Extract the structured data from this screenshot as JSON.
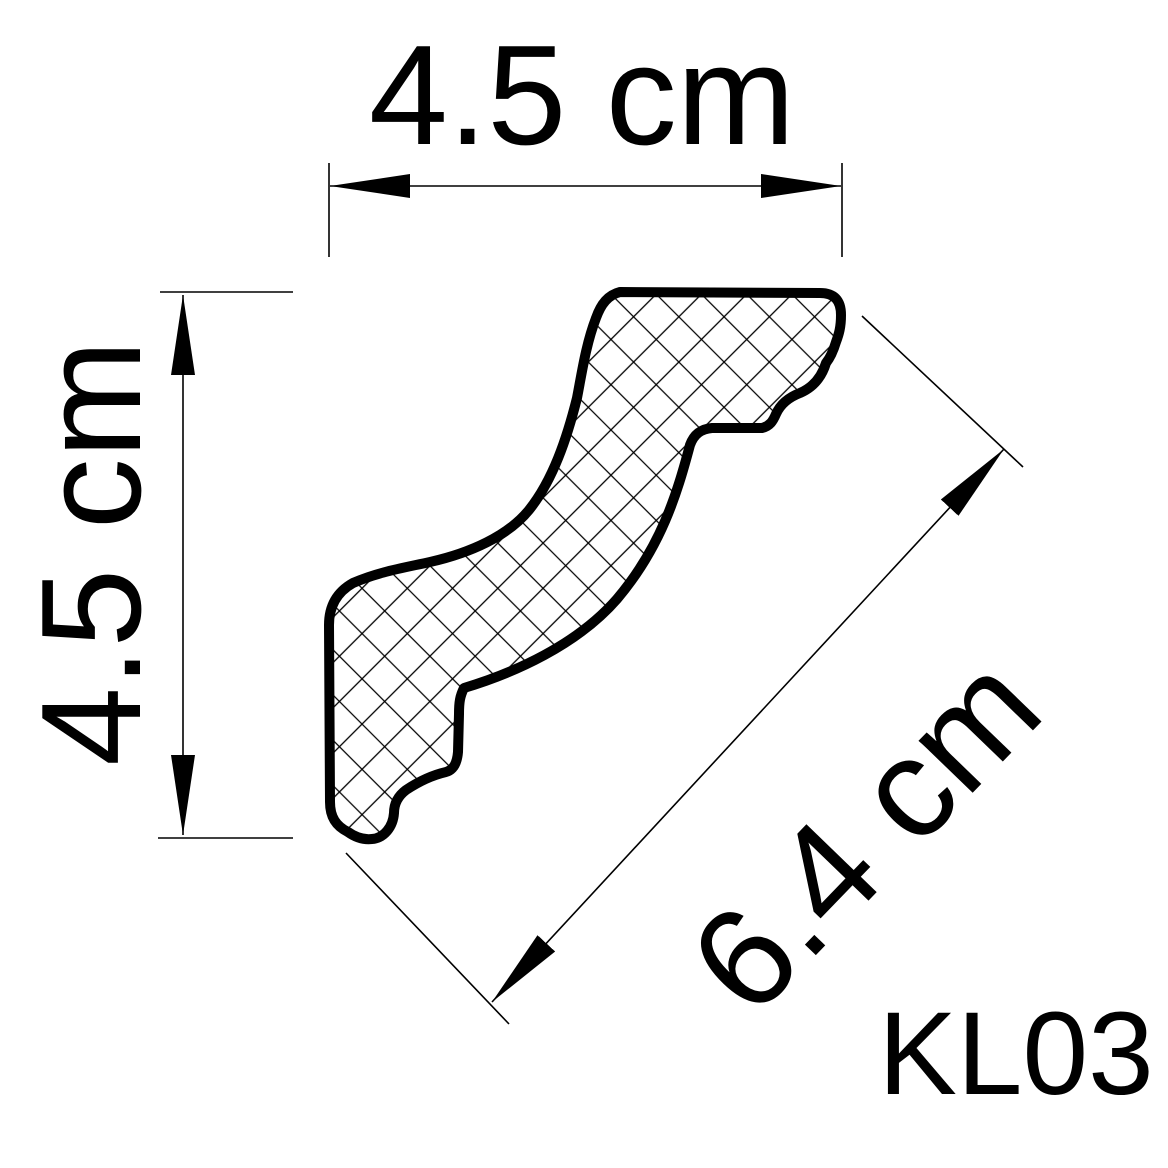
{
  "product": {
    "code": "KL03"
  },
  "dimensions": {
    "width_top": {
      "label": "4.5 cm",
      "value": 4.5,
      "unit": "cm",
      "orientation": "horizontal"
    },
    "height_left": {
      "label": "4.5 cm",
      "value": 4.5,
      "unit": "cm",
      "orientation": "vertical"
    },
    "face_diagonal": {
      "label": "6.4 cm",
      "value": 6.4,
      "unit": "cm",
      "orientation": "diagonal"
    }
  },
  "drawing": {
    "subject": "crown-molding-cross-section-profile",
    "fill_pattern": "crosshatch",
    "colors": {
      "line": "#000000",
      "background": "#ffffff"
    }
  }
}
